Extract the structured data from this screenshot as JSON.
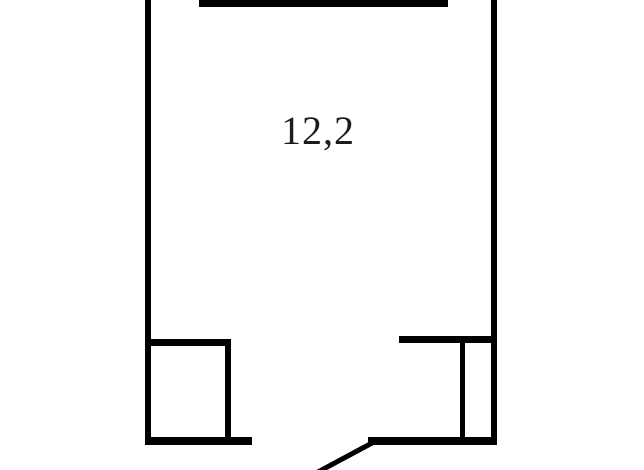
{
  "floorplan": {
    "title": "room-floor-plan",
    "area_label": "12,2",
    "colors": {
      "wall": "#000000",
      "background": "#ffffff",
      "label": "#1c1c1c"
    },
    "walls": [
      {
        "name": "left-wall",
        "x": 145,
        "y": 0,
        "w": 6,
        "h": 445
      },
      {
        "name": "top-wall",
        "x": 199,
        "y": 0,
        "w": 249,
        "h": 7
      },
      {
        "name": "right-wall",
        "x": 491,
        "y": 0,
        "w": 6,
        "h": 445
      },
      {
        "name": "bottom-left-wall",
        "x": 145,
        "y": 437,
        "w": 107,
        "h": 8
      },
      {
        "name": "bottom-right-wall",
        "x": 368,
        "y": 437,
        "w": 129,
        "h": 8
      },
      {
        "name": "left-closet-top-wall",
        "x": 148,
        "y": 339,
        "w": 83,
        "h": 7
      },
      {
        "name": "left-closet-side-wall",
        "x": 225,
        "y": 339,
        "w": 6,
        "h": 98
      },
      {
        "name": "right-closet-top-wall",
        "x": 399,
        "y": 336,
        "w": 92,
        "h": 7
      },
      {
        "name": "right-closet-side-wall",
        "x": 460,
        "y": 336,
        "w": 5,
        "h": 101
      }
    ],
    "door_leaf": {
      "name": "door-leaf-line",
      "x1": 318,
      "y1": 472,
      "x2": 372,
      "y2": 443,
      "stroke_width": 5
    },
    "openings": [
      {
        "name": "top-left-opening"
      },
      {
        "name": "top-right-opening"
      },
      {
        "name": "bottom-door-opening"
      }
    ]
  }
}
